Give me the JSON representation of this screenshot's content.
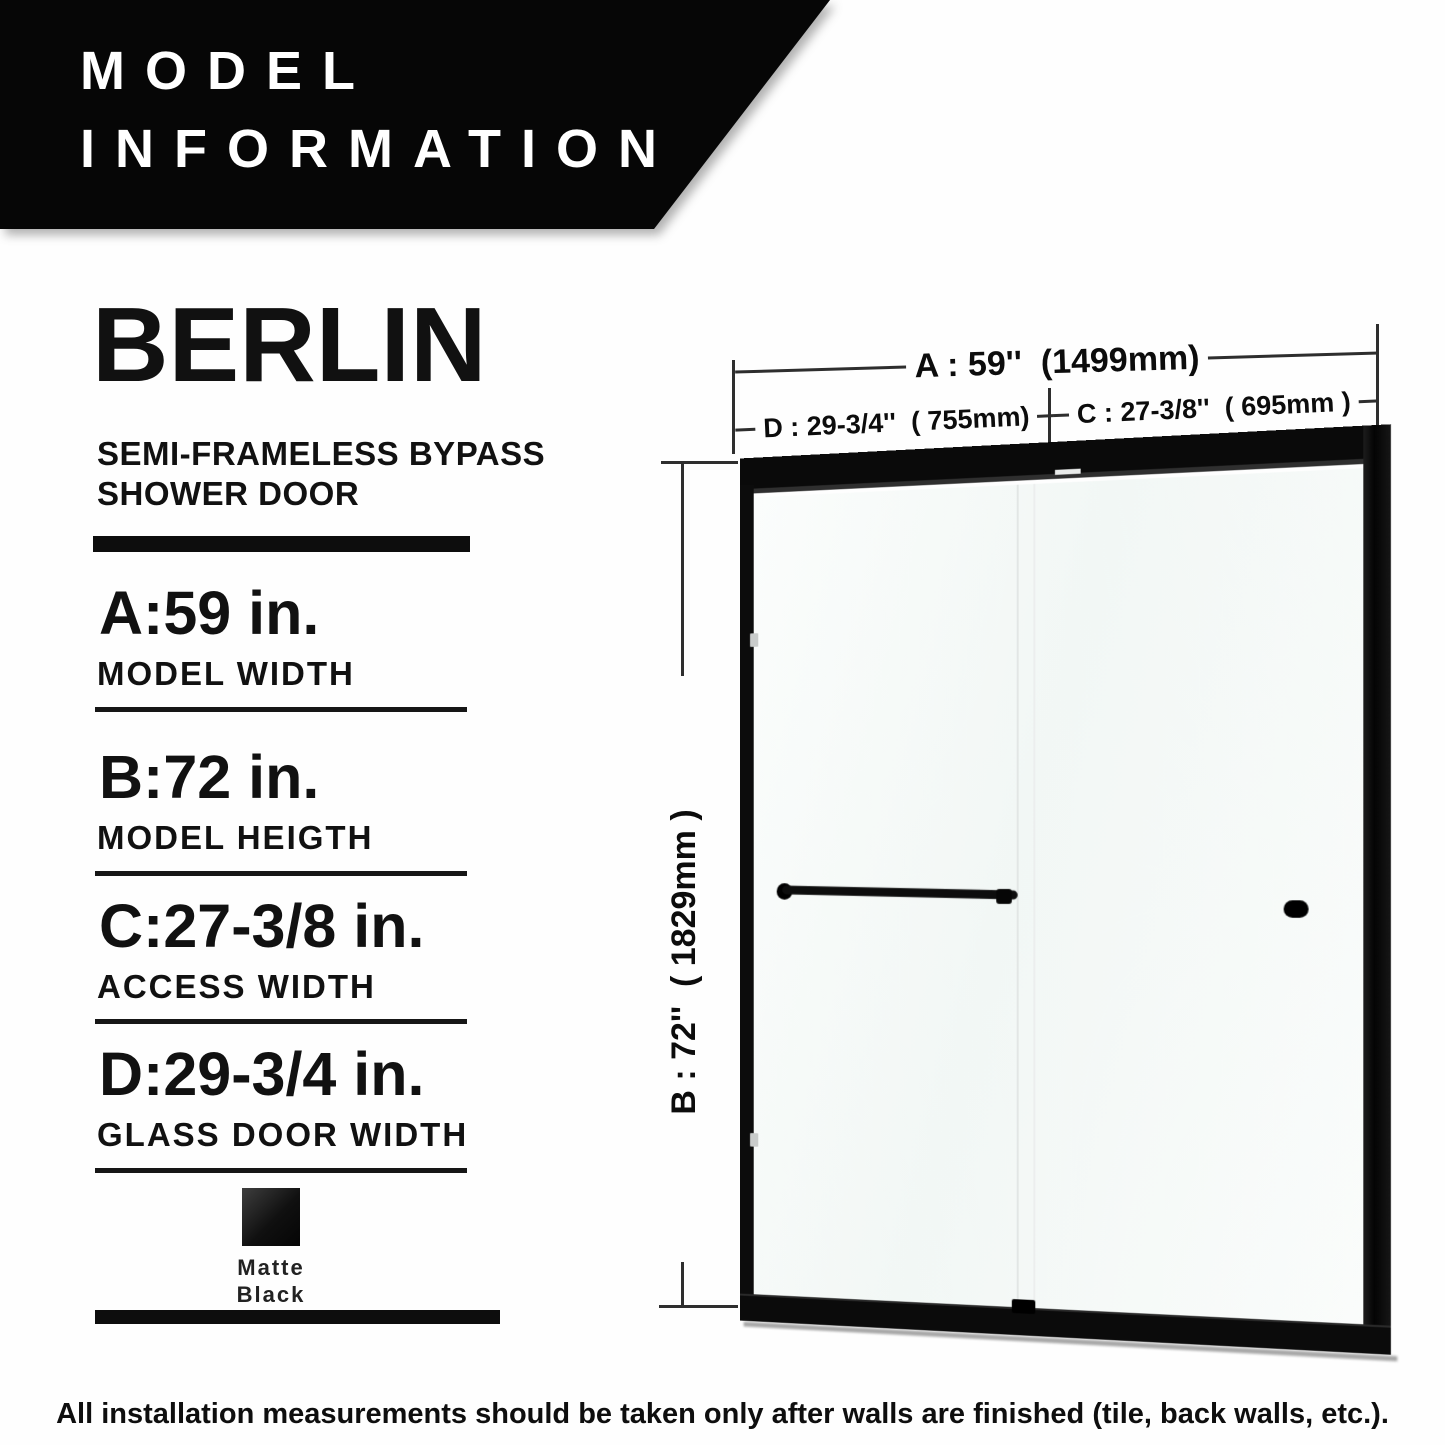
{
  "banner": {
    "line1": "MODEL",
    "line2": "INFORMATION",
    "bg_color": "#060606",
    "text_color": "#ffffff"
  },
  "product": {
    "name": "BERLIN",
    "subtitle": [
      "SEMI-FRAMELESS BYPASS",
      "SHOWER DOOR"
    ]
  },
  "specs": [
    {
      "value": "A:59 in.",
      "label": "MODEL WIDTH"
    },
    {
      "value": "B:72 in.",
      "label": "MODEL HEIGTH"
    },
    {
      "value": "C:27-3/8 in.",
      "label": "ACCESS WIDTH"
    },
    {
      "value": "D:29-3/4 in.",
      "label": "GLASS DOOR WIDTH"
    }
  ],
  "finish": {
    "line1": "Matte",
    "line2": "Black",
    "swatch_color": "#161616"
  },
  "diagram": {
    "dim_a": "A : 59''  (1499mm)",
    "dim_d": "D : 29-3/4''  ( 755mm)",
    "dim_c": "C : 27-3/8''  ( 695mm )",
    "dim_b": "B : 72''  ( 1829mm )",
    "frame_color": "#0b0b0b"
  },
  "footer": {
    "note": "All installation measurements should be taken only after walls are finished (tile, back walls, etc.)."
  }
}
